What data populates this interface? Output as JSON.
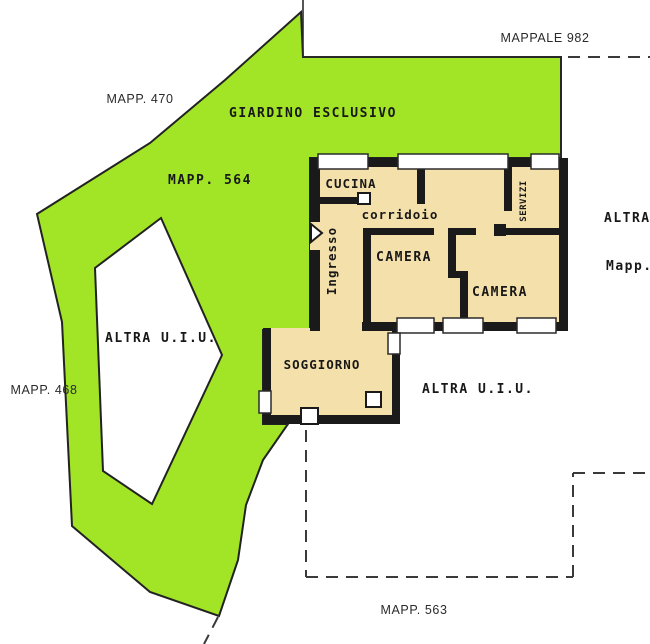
{
  "plan": {
    "title": "cadastral floor plan",
    "labels": {
      "mappale_982": "MAPPALE 982",
      "mapp_470": "MAPP. 470",
      "mapp_564": "MAPP. 564",
      "mapp_468": "MAPP. 468",
      "mapp_563": "MAPP. 563",
      "giardino": "GIARDINO ESCLUSIVO",
      "altra_uiu_west": "ALTRA U.I.U.",
      "altra_uiu_east": "ALTRA U.I.U.",
      "altra_edge": "ALTRA",
      "mapp_edge": "Mapp."
    },
    "rooms": {
      "cucina": "CUCINA",
      "corridoio": "corridoio",
      "ingresso": "Ingresso",
      "camera_1": "CAMERA",
      "camera_2": "CAMERA",
      "servizi": "SERVIZI",
      "soggiorno": "SOGGIORNO"
    },
    "colors": {
      "garden_green": "#a2e426",
      "floor_beige": "#f4e0aa",
      "wall": "#1a1a1a",
      "boundary": "#3a3a3a"
    }
  }
}
